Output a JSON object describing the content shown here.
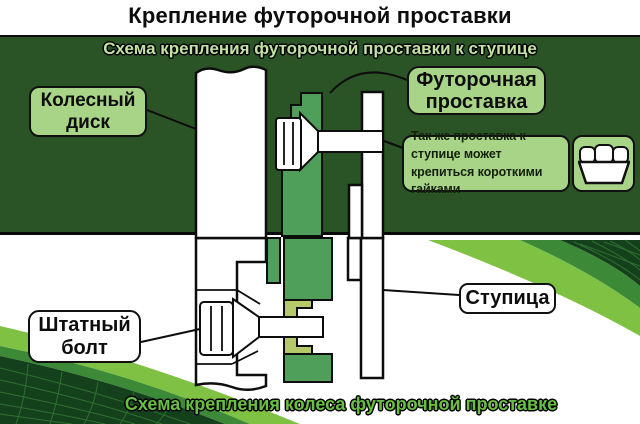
{
  "title": "Крепление футорочной проставки",
  "banners": {
    "top": "Схема крепления футорочной проставки к ступице",
    "bottom": "Схема крепления колеса футорочной проставке"
  },
  "callouts": {
    "wheel_disk": {
      "label": "Колесный диск"
    },
    "spacer": {
      "label": "Футорочная проставка"
    },
    "note": {
      "label": "Так же проставка к ступице может крепиться короткими гайками"
    },
    "hub": {
      "label": "Ступица"
    },
    "stock_bolt": {
      "label": "Штатный болт"
    }
  },
  "icons": {
    "nut_icon": "short-wheel-nut"
  },
  "colors": {
    "dark_green_bg": "#2a5425",
    "spacer_green": "#4f9e59",
    "insert_yellow_green": "#b4c96a",
    "label_green": "#a8d488",
    "banner_text_light": "#c2e2a4",
    "bottom_text_green": "#68bf41",
    "swoosh_light": "#7fc243",
    "swoosh_medium": "#3c8a38",
    "swoosh_dark": "#14401c",
    "swoosh_grid": "#2f7030",
    "outline_black": "#0d0d0d"
  }
}
